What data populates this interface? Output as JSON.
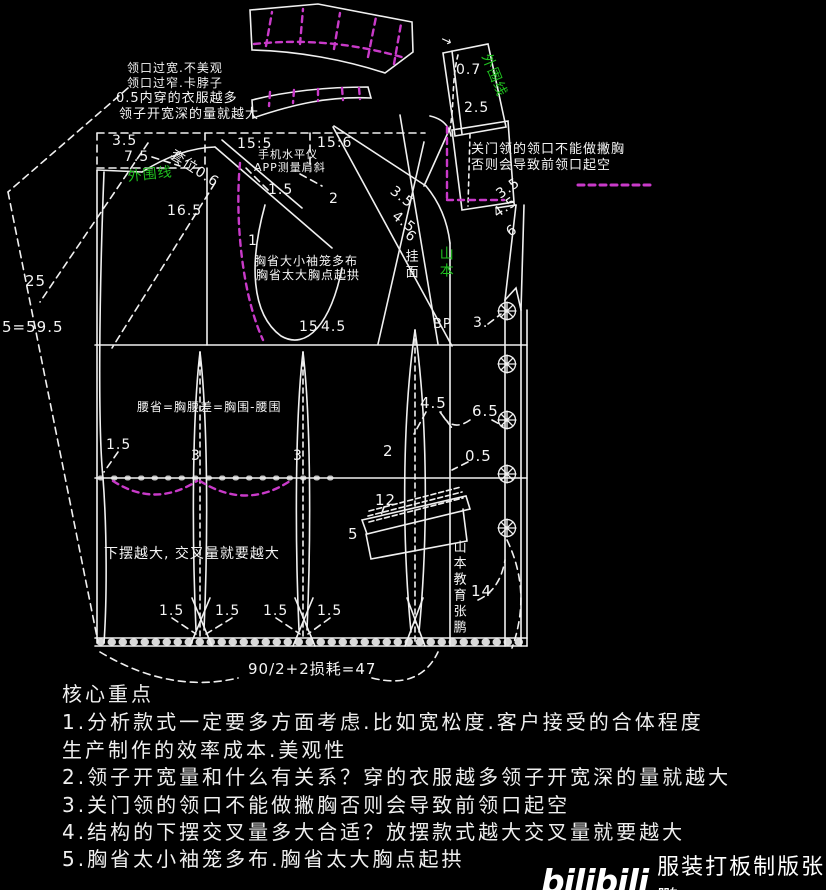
{
  "colors": {
    "background": "#000000",
    "line": "#f0f0f0",
    "magenta": "#c93ac9",
    "green": "#1fc01f",
    "white": "#f5f5f5"
  },
  "watermark": {
    "logo": "bilibili",
    "label": "服装打板制版张鹏"
  },
  "notes": {
    "title": "核心重点",
    "lines": [
      "1.分析款式一定要多方面考虑.比如宽松度.客户接受的合体程度",
      "生产制作的效率成本.美观性",
      "2.领子开宽量和什么有关系？穿的衣服越多领子开宽深的量就越大",
      "3.关门领的领口不能做撇胸否则会导致前领口起空",
      "4.结构的下摆交叉量多大合适？放摆款式越大交叉量就要越大",
      "5.胸省太小袖笼多布.胸省太大胸点起拱"
    ]
  },
  "annotations": [
    {
      "name": "note-neck-wide",
      "text": "领口过宽.不美观",
      "x": 127,
      "y": 62,
      "s": 12
    },
    {
      "name": "note-neck-narrow",
      "text": "领口过窄.卡脖子",
      "x": 127,
      "y": 77,
      "s": 12
    },
    {
      "name": "note-inner-layers",
      "text": "0.5内穿的衣服越多",
      "x": 116,
      "y": 92,
      "s": 13
    },
    {
      "name": "note-neck-depth",
      "text": "领子开宽深的量就越大",
      "x": 119,
      "y": 108,
      "s": 13
    },
    {
      "name": "dim-3-5-back-neck",
      "text": "3.5",
      "x": 112,
      "y": 134,
      "s": 14
    },
    {
      "name": "dim-7-5-back-neck",
      "text": "7.5",
      "x": 124,
      "y": 150,
      "s": 14
    },
    {
      "name": "ratio-back-shoulder",
      "text": "15:5",
      "x": 237,
      "y": 137,
      "s": 14
    },
    {
      "name": "ratio-front-shoulder",
      "text": "15:6",
      "x": 317,
      "y": 136,
      "s": 14
    },
    {
      "name": "note-phone-level-1",
      "text": "手机水平仪",
      "x": 258,
      "y": 149,
      "s": 11
    },
    {
      "name": "note-phone-level-2",
      "text": "APP测量肩斜",
      "x": 254,
      "y": 162,
      "s": 11
    },
    {
      "name": "label-outline-left",
      "text": "外围线",
      "x": 127,
      "y": 170,
      "s": 14,
      "color": "green",
      "rot": -6
    },
    {
      "name": "dim-collar-offset",
      "text": "套位0.6",
      "x": 175,
      "y": 148,
      "s": 14,
      "rot": 33
    },
    {
      "name": "dim-1-5-shoulder",
      "text": "1.5",
      "x": 268,
      "y": 183,
      "s": 14
    },
    {
      "name": "dim-2-shoulder",
      "text": "2",
      "x": 329,
      "y": 192,
      "s": 14
    },
    {
      "name": "dim-16-5",
      "text": "16.5",
      "x": 167,
      "y": 204,
      "s": 14
    },
    {
      "name": "dim-1",
      "text": "1",
      "x": 248,
      "y": 234,
      "s": 14
    },
    {
      "name": "dim-3-5-front-shoulder",
      "text": "3.5",
      "x": 396,
      "y": 184,
      "s": 14,
      "rot": 38
    },
    {
      "name": "dim-4-5-front-shoulder",
      "text": "4.5",
      "x": 398,
      "y": 209,
      "s": 14,
      "rot": 38
    },
    {
      "name": "dim-6-front-shoulder",
      "text": "6",
      "x": 411,
      "y": 228,
      "s": 14,
      "rot": 38
    },
    {
      "name": "dim-25",
      "text": "25",
      "x": 25,
      "y": 274,
      "s": 15
    },
    {
      "name": "dim-5-59-5",
      "text": "5=59.5",
      "x": 2,
      "y": 320,
      "s": 15
    },
    {
      "name": "note-dart-small",
      "text": "胸省大小袖笼多布",
      "x": 254,
      "y": 255,
      "s": 12
    },
    {
      "name": "note-dart-large",
      "text": "胸省太大胸点起拱",
      "x": 256,
      "y": 269,
      "s": 12
    },
    {
      "name": "dim-15-armhole",
      "text": "15",
      "x": 299,
      "y": 320,
      "s": 14
    },
    {
      "name": "dim-4-5-armhole",
      "text": "4.5",
      "x": 321,
      "y": 320,
      "s": 14
    },
    {
      "name": "note-closed-collar-1",
      "text": "关门领的领口不能做撇胸",
      "x": 471,
      "y": 143,
      "s": 13
    },
    {
      "name": "note-closed-collar-2",
      "text": "否则会导致前领口起空",
      "x": 471,
      "y": 159,
      "s": 13
    },
    {
      "name": "dim-0-7-collar",
      "text": "0.7",
      "x": 456,
      "y": 63,
      "s": 14
    },
    {
      "name": "dim-2-5-collar",
      "text": "2.5",
      "x": 464,
      "y": 101,
      "s": 14
    },
    {
      "name": "label-outline-right",
      "text": "外围线",
      "x": 492,
      "y": 52,
      "s": 14,
      "color": "green",
      "rot": 68
    },
    {
      "name": "arrow-mark",
      "text": "→",
      "x": 444,
      "y": 33,
      "s": 13,
      "rot": 25
    },
    {
      "name": "label-facing",
      "text": "挂面",
      "x": 403,
      "y": 249,
      "s": 13,
      "vertical": true
    },
    {
      "name": "watermark-green",
      "text": "山本",
      "x": 438,
      "y": 246,
      "s": 14,
      "color": "green",
      "vertical": true
    },
    {
      "name": "label-bp",
      "text": "BP",
      "x": 433,
      "y": 318,
      "s": 13
    },
    {
      "name": "dim-3-neck",
      "text": "3.",
      "x": 473,
      "y": 316,
      "s": 14
    },
    {
      "name": "dim-3-5-front-neck",
      "text": "3.5",
      "x": 494,
      "y": 190,
      "s": 14,
      "rot": -35
    },
    {
      "name": "dim-4-5-front-neck",
      "text": "4.5",
      "x": 491,
      "y": 209,
      "s": 14,
      "rot": -35
    },
    {
      "name": "dim-6-front-neck",
      "text": "6",
      "x": 504,
      "y": 228,
      "s": 14,
      "rot": -35
    },
    {
      "name": "formula-waist-dart",
      "text": "腰省=胸腰差=胸围-腰围",
      "x": 137,
      "y": 401,
      "s": 12
    },
    {
      "name": "dim-4-5-waist",
      "text": "4.5",
      "x": 420,
      "y": 396,
      "s": 15
    },
    {
      "name": "dim-6-5-waist",
      "text": "6.5",
      "x": 472,
      "y": 404,
      "s": 15
    },
    {
      "name": "dim-2-dart",
      "text": "2",
      "x": 383,
      "y": 444,
      "s": 15
    },
    {
      "name": "dim-0-5",
      "text": "0.5",
      "x": 465,
      "y": 449,
      "s": 15
    },
    {
      "name": "dim-1-5-side",
      "text": "1.5",
      "x": 106,
      "y": 438,
      "s": 14
    },
    {
      "name": "dim-3-dart-a",
      "text": "3",
      "x": 191,
      "y": 449,
      "s": 14
    },
    {
      "name": "dim-3-dart-b",
      "text": "3",
      "x": 293,
      "y": 449,
      "s": 14
    },
    {
      "name": "dim-12-pocket",
      "text": "12",
      "x": 375,
      "y": 493,
      "s": 15
    },
    {
      "name": "dim-5-pocket",
      "text": "5",
      "x": 348,
      "y": 527,
      "s": 15
    },
    {
      "name": "dim-14",
      "text": "14",
      "x": 471,
      "y": 584,
      "s": 15
    },
    {
      "name": "watermark-vertical",
      "text": "山本教育张鹏",
      "x": 451,
      "y": 540,
      "s": 13,
      "vertical": true
    },
    {
      "name": "note-hem",
      "text": "下摆越大, 交叉量就要越大",
      "x": 104,
      "y": 547,
      "s": 14
    },
    {
      "name": "dim-1-5-hem-a",
      "text": "1.5",
      "x": 159,
      "y": 604,
      "s": 14
    },
    {
      "name": "dim-1-5-hem-b",
      "text": "1.5",
      "x": 215,
      "y": 604,
      "s": 14
    },
    {
      "name": "dim-1-5-hem-c",
      "text": "1.5",
      "x": 263,
      "y": 604,
      "s": 14
    },
    {
      "name": "dim-1-5-hem-d",
      "text": "1.5",
      "x": 317,
      "y": 604,
      "s": 14
    },
    {
      "name": "formula-hem",
      "text": "90/2+2损耗=47",
      "x": 248,
      "y": 662,
      "s": 15
    }
  ]
}
